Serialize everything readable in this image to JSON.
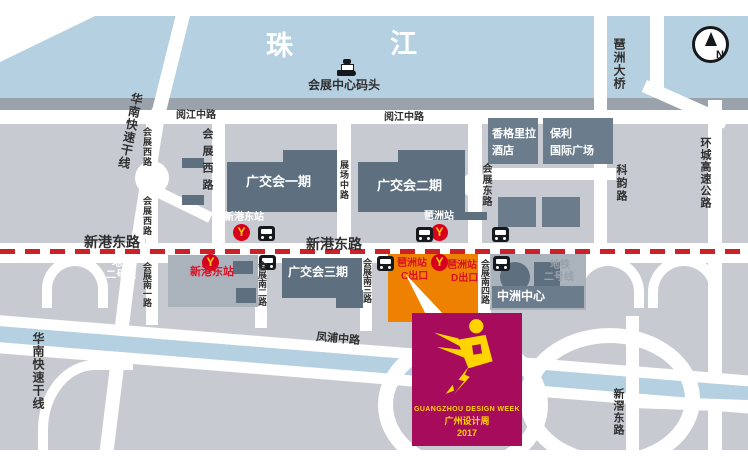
{
  "colors": {
    "land": "#c7cbd1",
    "river": "#b5d1e1",
    "shore": "#9aa2ab",
    "road": "#ffffff",
    "building-dark": "#5e7080",
    "building-mid": "#6b7d8d",
    "building-light": "#aab3bc",
    "orange": "#ee8200",
    "magenta": "#a70b5c",
    "logo-yellow": "#ffd400",
    "metro-red": "#d6001c",
    "metro-yellow": "#ffd400",
    "dash-red": "#cc2128",
    "station-red": "#d81126",
    "text-dark": "#2f2f2f"
  },
  "river": {
    "char1": "珠",
    "char2": "江",
    "pier": "会展中心码头"
  },
  "compass": {
    "letter": "N"
  },
  "roads": {
    "yuejiang_left": "阅江中路",
    "yuejiang_center": "阅江中路",
    "xingang_left": "新港东路",
    "xingang_center": "新港东路",
    "huanan_top": "华南快速干线",
    "huanan_bottom": "华南快速干线",
    "huizhanxi_a": "会展西路",
    "huizhanxi_b": "会展西路",
    "huizhanxi_c": "会展西路",
    "zhanchang": "展场中路",
    "huizhandong": "会展东路",
    "keyun": "科韵路",
    "pazhou_bridge": "琶洲大桥",
    "huancheng": "环城高速公路",
    "xinjiao": "新滘东路",
    "fengpu": "凤浦中路",
    "huizhan_nan1": "会展南一路",
    "huizhan_nan2": "会展南二路",
    "huizhan_nan3": "会展南三路",
    "huizhan_nan4": "会展南四路"
  },
  "buildings": {
    "phase1": "广交会一期",
    "phase2": "广交会二期",
    "phase3": "广交会三期",
    "shangrila_line1": "香格里拉",
    "shangrila_line2": "酒店",
    "poly_line1": "保利",
    "poly_line2": "国际广场",
    "zhongzhou": "中洲中心"
  },
  "stations": {
    "xingang_above": "新港东站",
    "xingang_below": "新港东站",
    "pazhou_above": "琶洲站",
    "pazhou_exit_c_line1": "琶洲站",
    "pazhou_exit_c_line2": "C出口",
    "pazhou_exit_d_line1": "琶洲站",
    "pazhou_exit_d_line2": "D出口",
    "metro2_left_line1": "地铁",
    "metro2_left_line2": "二号线",
    "metro2_right_line1": "地铁",
    "metro2_right_line2": "二号线",
    "metro_logo_letter": "Y"
  },
  "logo": {
    "line1": "GUANGZHOU DESIGN WEEK",
    "line2": "广州设计周",
    "line3": "2017"
  }
}
